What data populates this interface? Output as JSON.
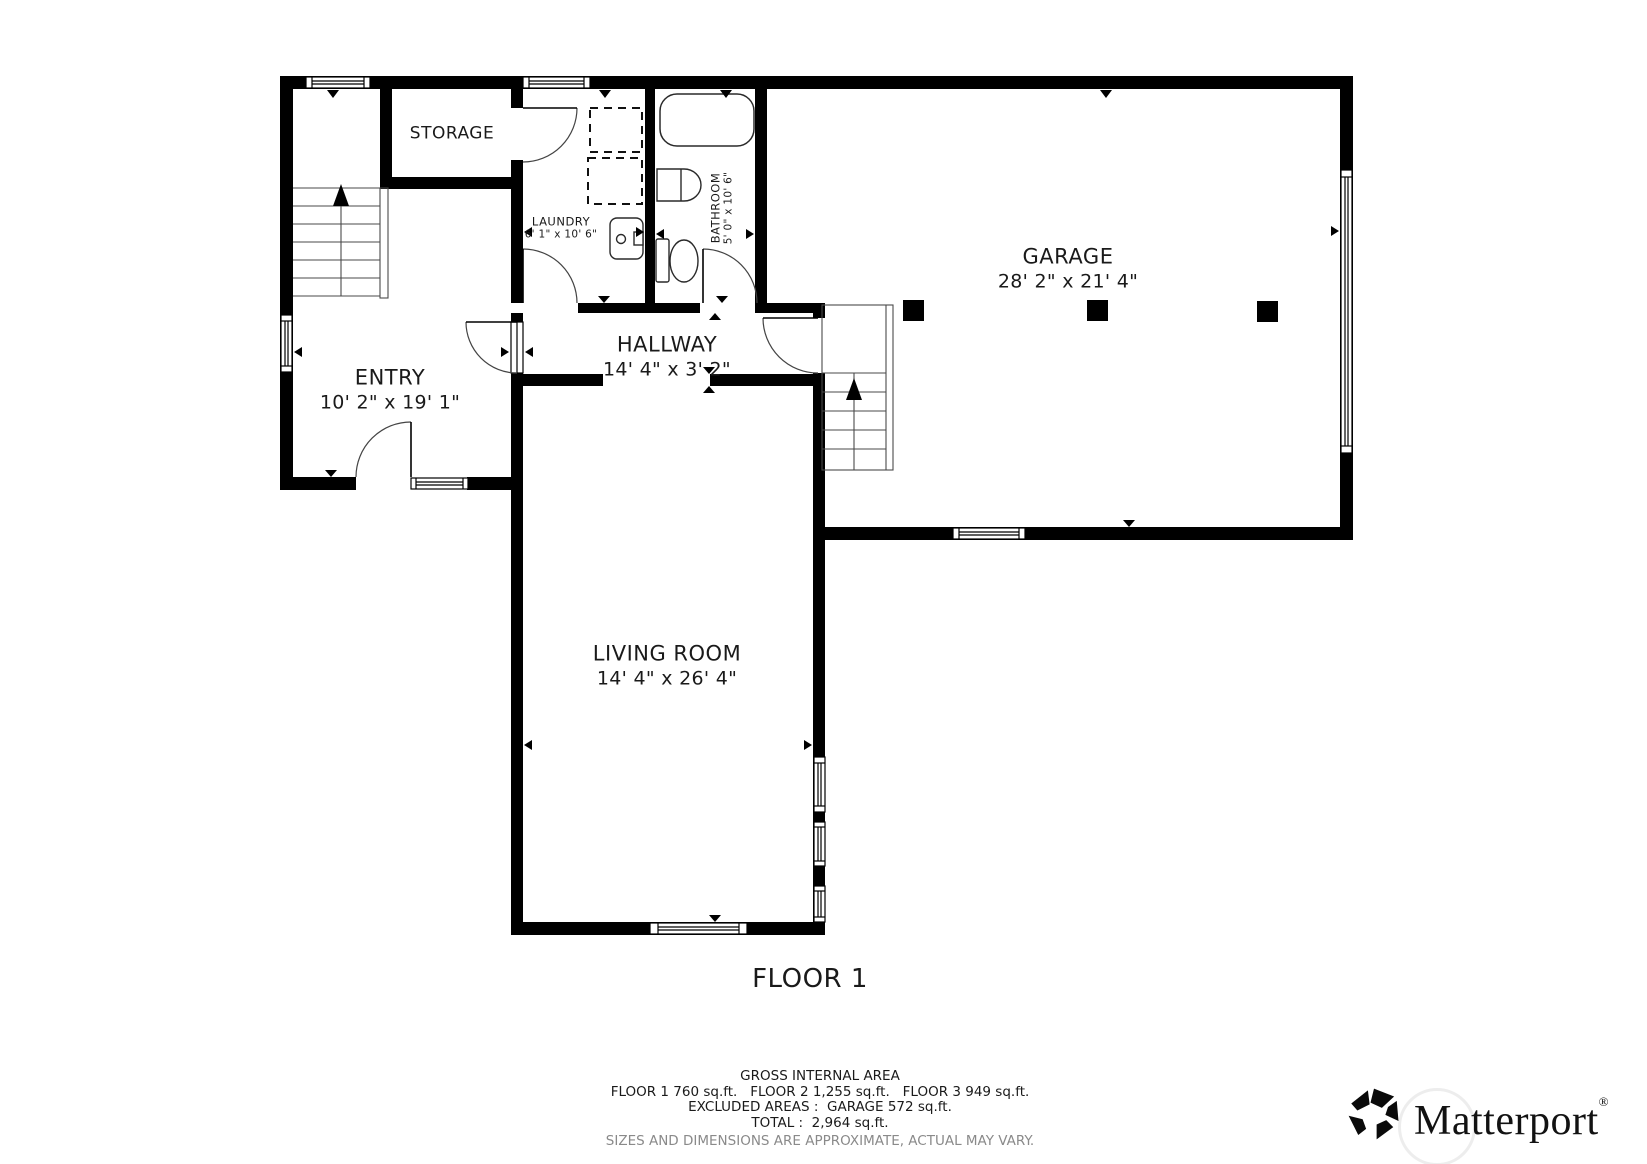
{
  "floor_plan": {
    "floor_title": "FLOOR 1",
    "rooms": {
      "storage": {
        "name": "STORAGE",
        "dims": ""
      },
      "laundry": {
        "name": "LAUNDRY",
        "dims": "6' 1\" x 10' 6\""
      },
      "bathroom": {
        "name": "BATHROOM",
        "dims": "5' 0\" x 10' 6\""
      },
      "entry": {
        "name": "ENTRY",
        "dims": "10' 2\" x 19' 1\""
      },
      "hallway": {
        "name": "HALLWAY",
        "dims": "14' 4\" x 3' 2\""
      },
      "garage": {
        "name": "GARAGE",
        "dims": "28' 2\" x 21' 4\""
      },
      "living_room": {
        "name": "LIVING ROOM",
        "dims": "14' 4\" x 26' 4\""
      }
    }
  },
  "area_summary": {
    "heading": "GROSS INTERNAL AREA",
    "floors": "FLOOR 1 760 sq.ft.   FLOOR 2 1,255 sq.ft.   FLOOR 3 949 sq.ft.",
    "excluded": "EXCLUDED AREAS :  GARAGE 572 sq.ft.",
    "total": "TOTAL :  2,964 sq.ft.",
    "disclaimer": "SIZES AND DIMENSIONS ARE APPROXIMATE, ACTUAL MAY VARY."
  },
  "brand": {
    "wordmark": "Matterport",
    "registered_symbol": "®"
  },
  "colors": {
    "wall": "#000000",
    "stair_line": "#4a4a4a",
    "door_arc": "#444444",
    "muted_text": "#8a8a8a"
  }
}
